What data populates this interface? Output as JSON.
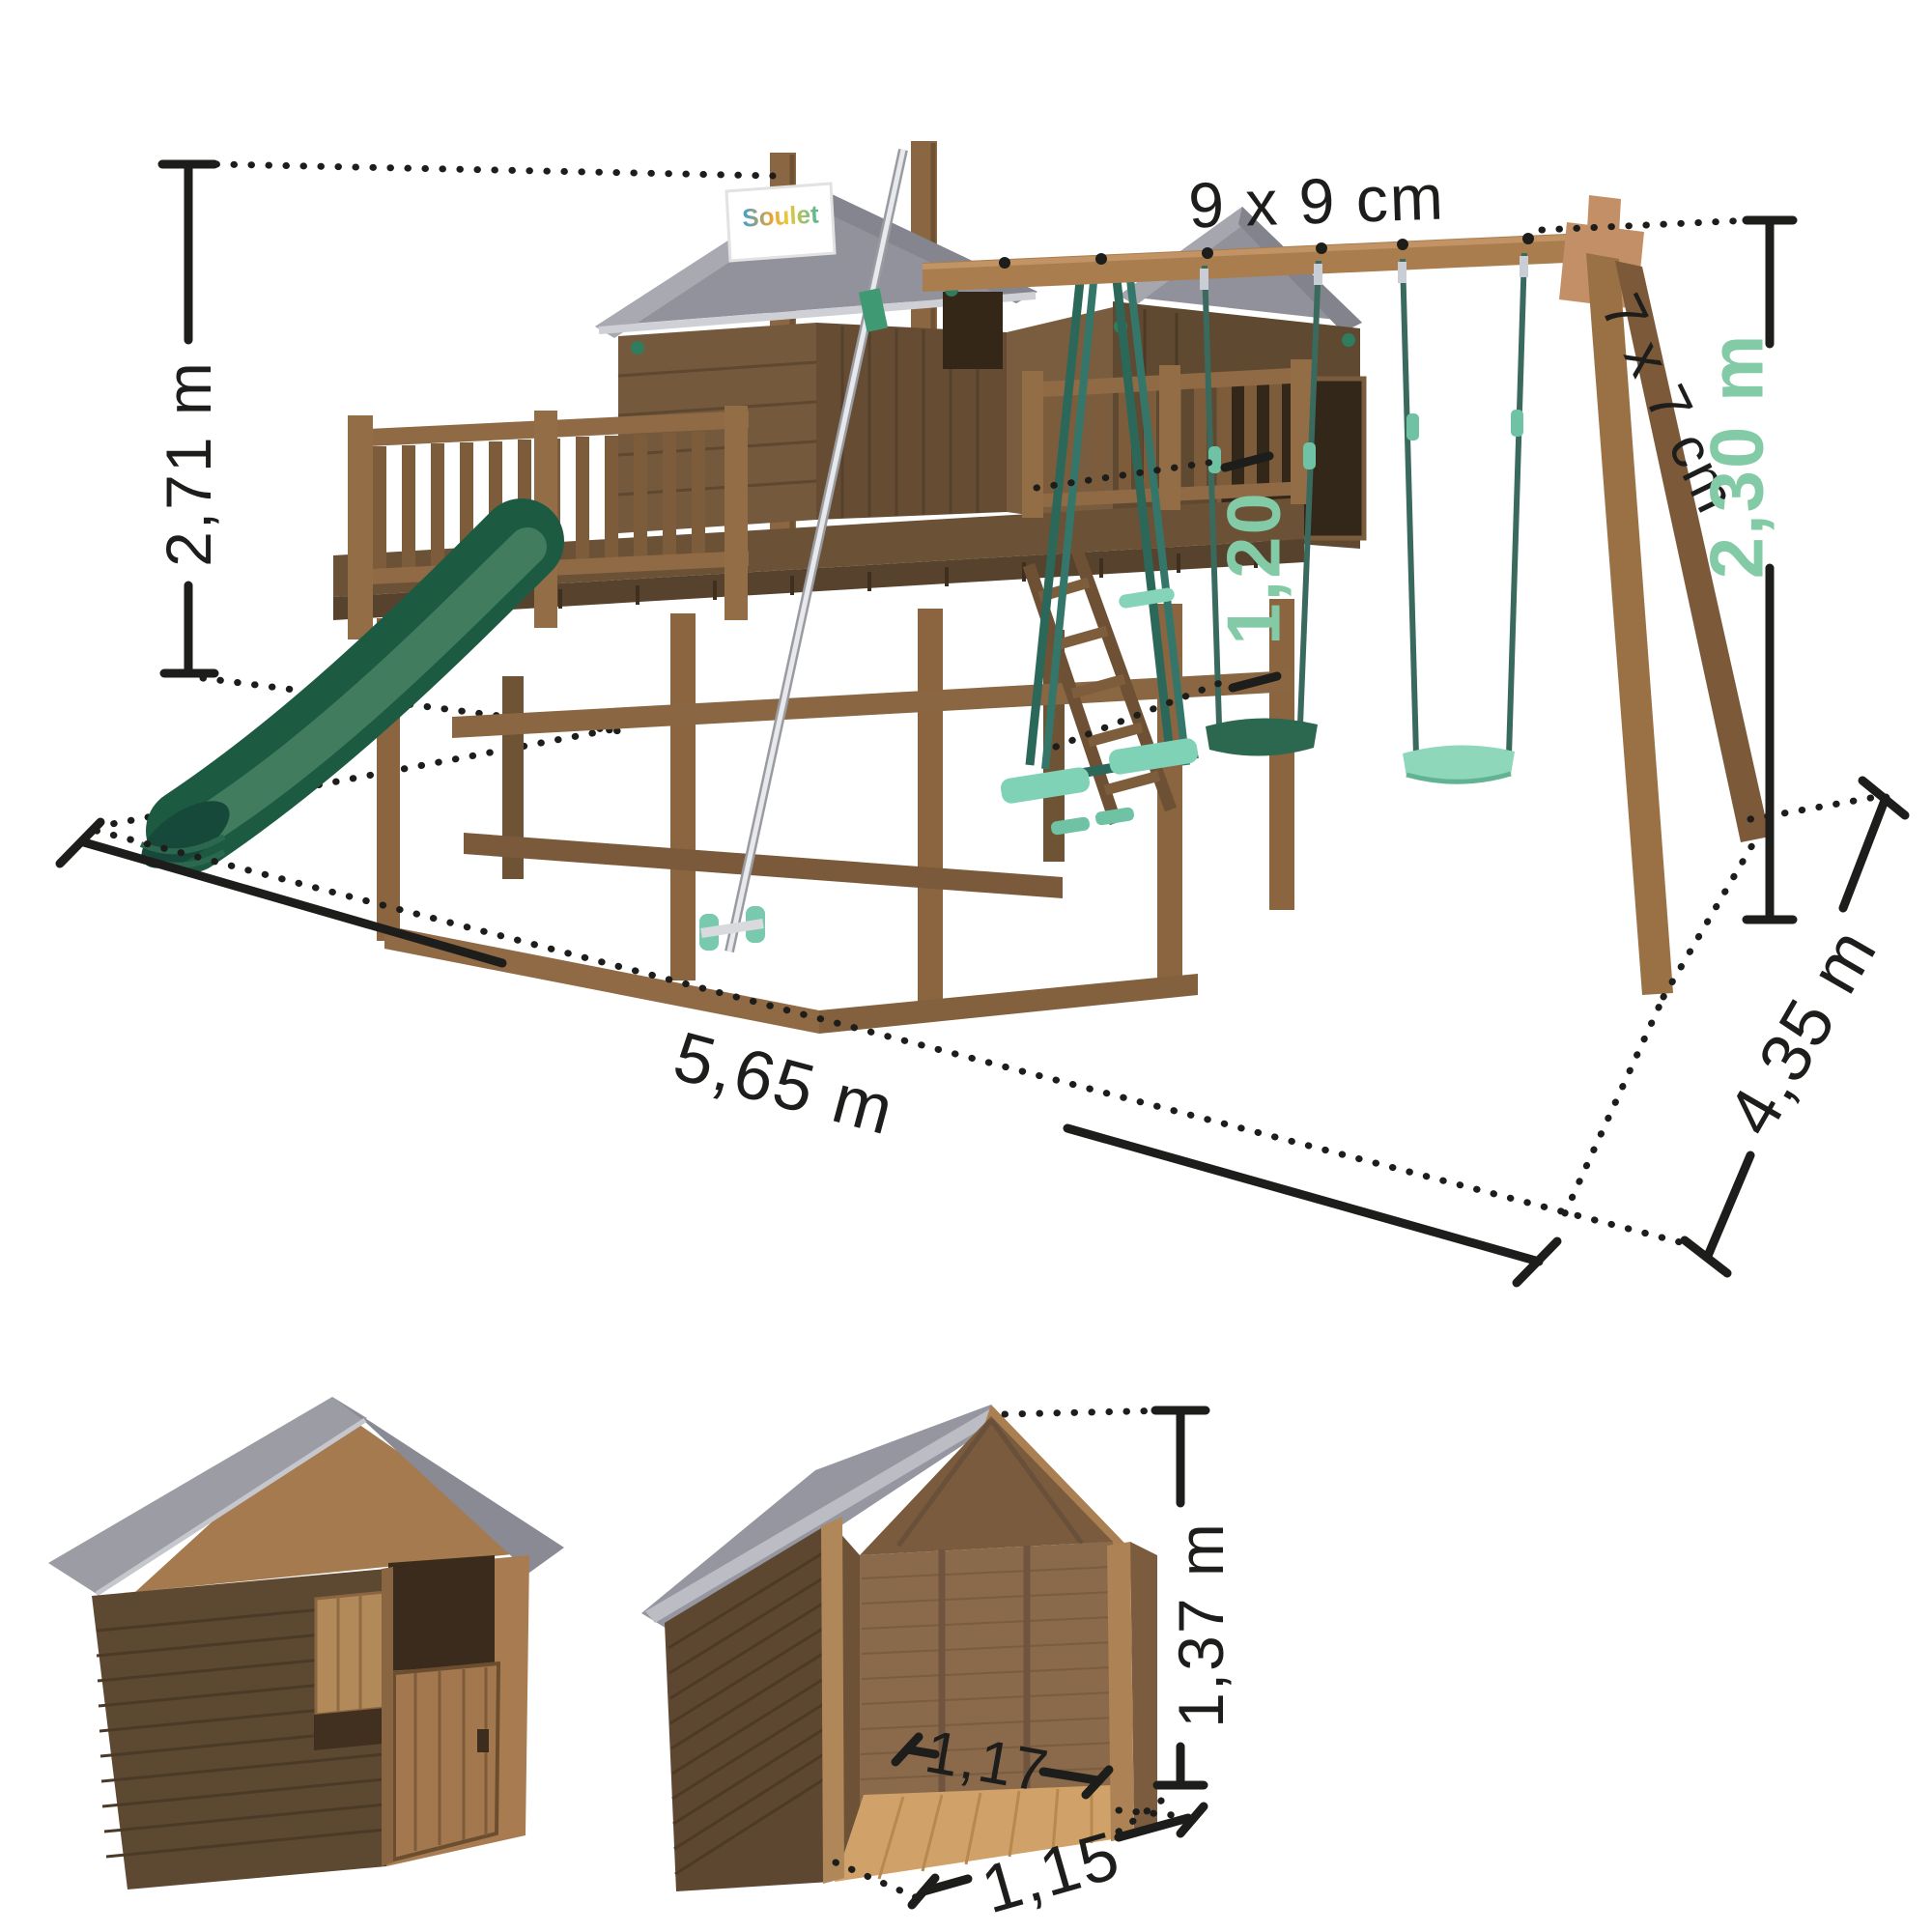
{
  "page": {
    "background": "#ffffff"
  },
  "playset_view": {
    "logo_flag": "Soulet",
    "accent_color": "#83caa6",
    "dims": {
      "total_height": "2,71 m",
      "beam_section": "9 x 9 cm",
      "leg_section": "7 x 7 cm",
      "swing_beam_height": "2,30 m",
      "platform_height": "1,20",
      "footprint_length": "5,65 m",
      "footprint_depth": "4,35 m"
    }
  },
  "playhouse_view": {
    "dims": {
      "house_height": "1,37 m",
      "interior_width": "1,17",
      "front_width": "1,15"
    }
  }
}
